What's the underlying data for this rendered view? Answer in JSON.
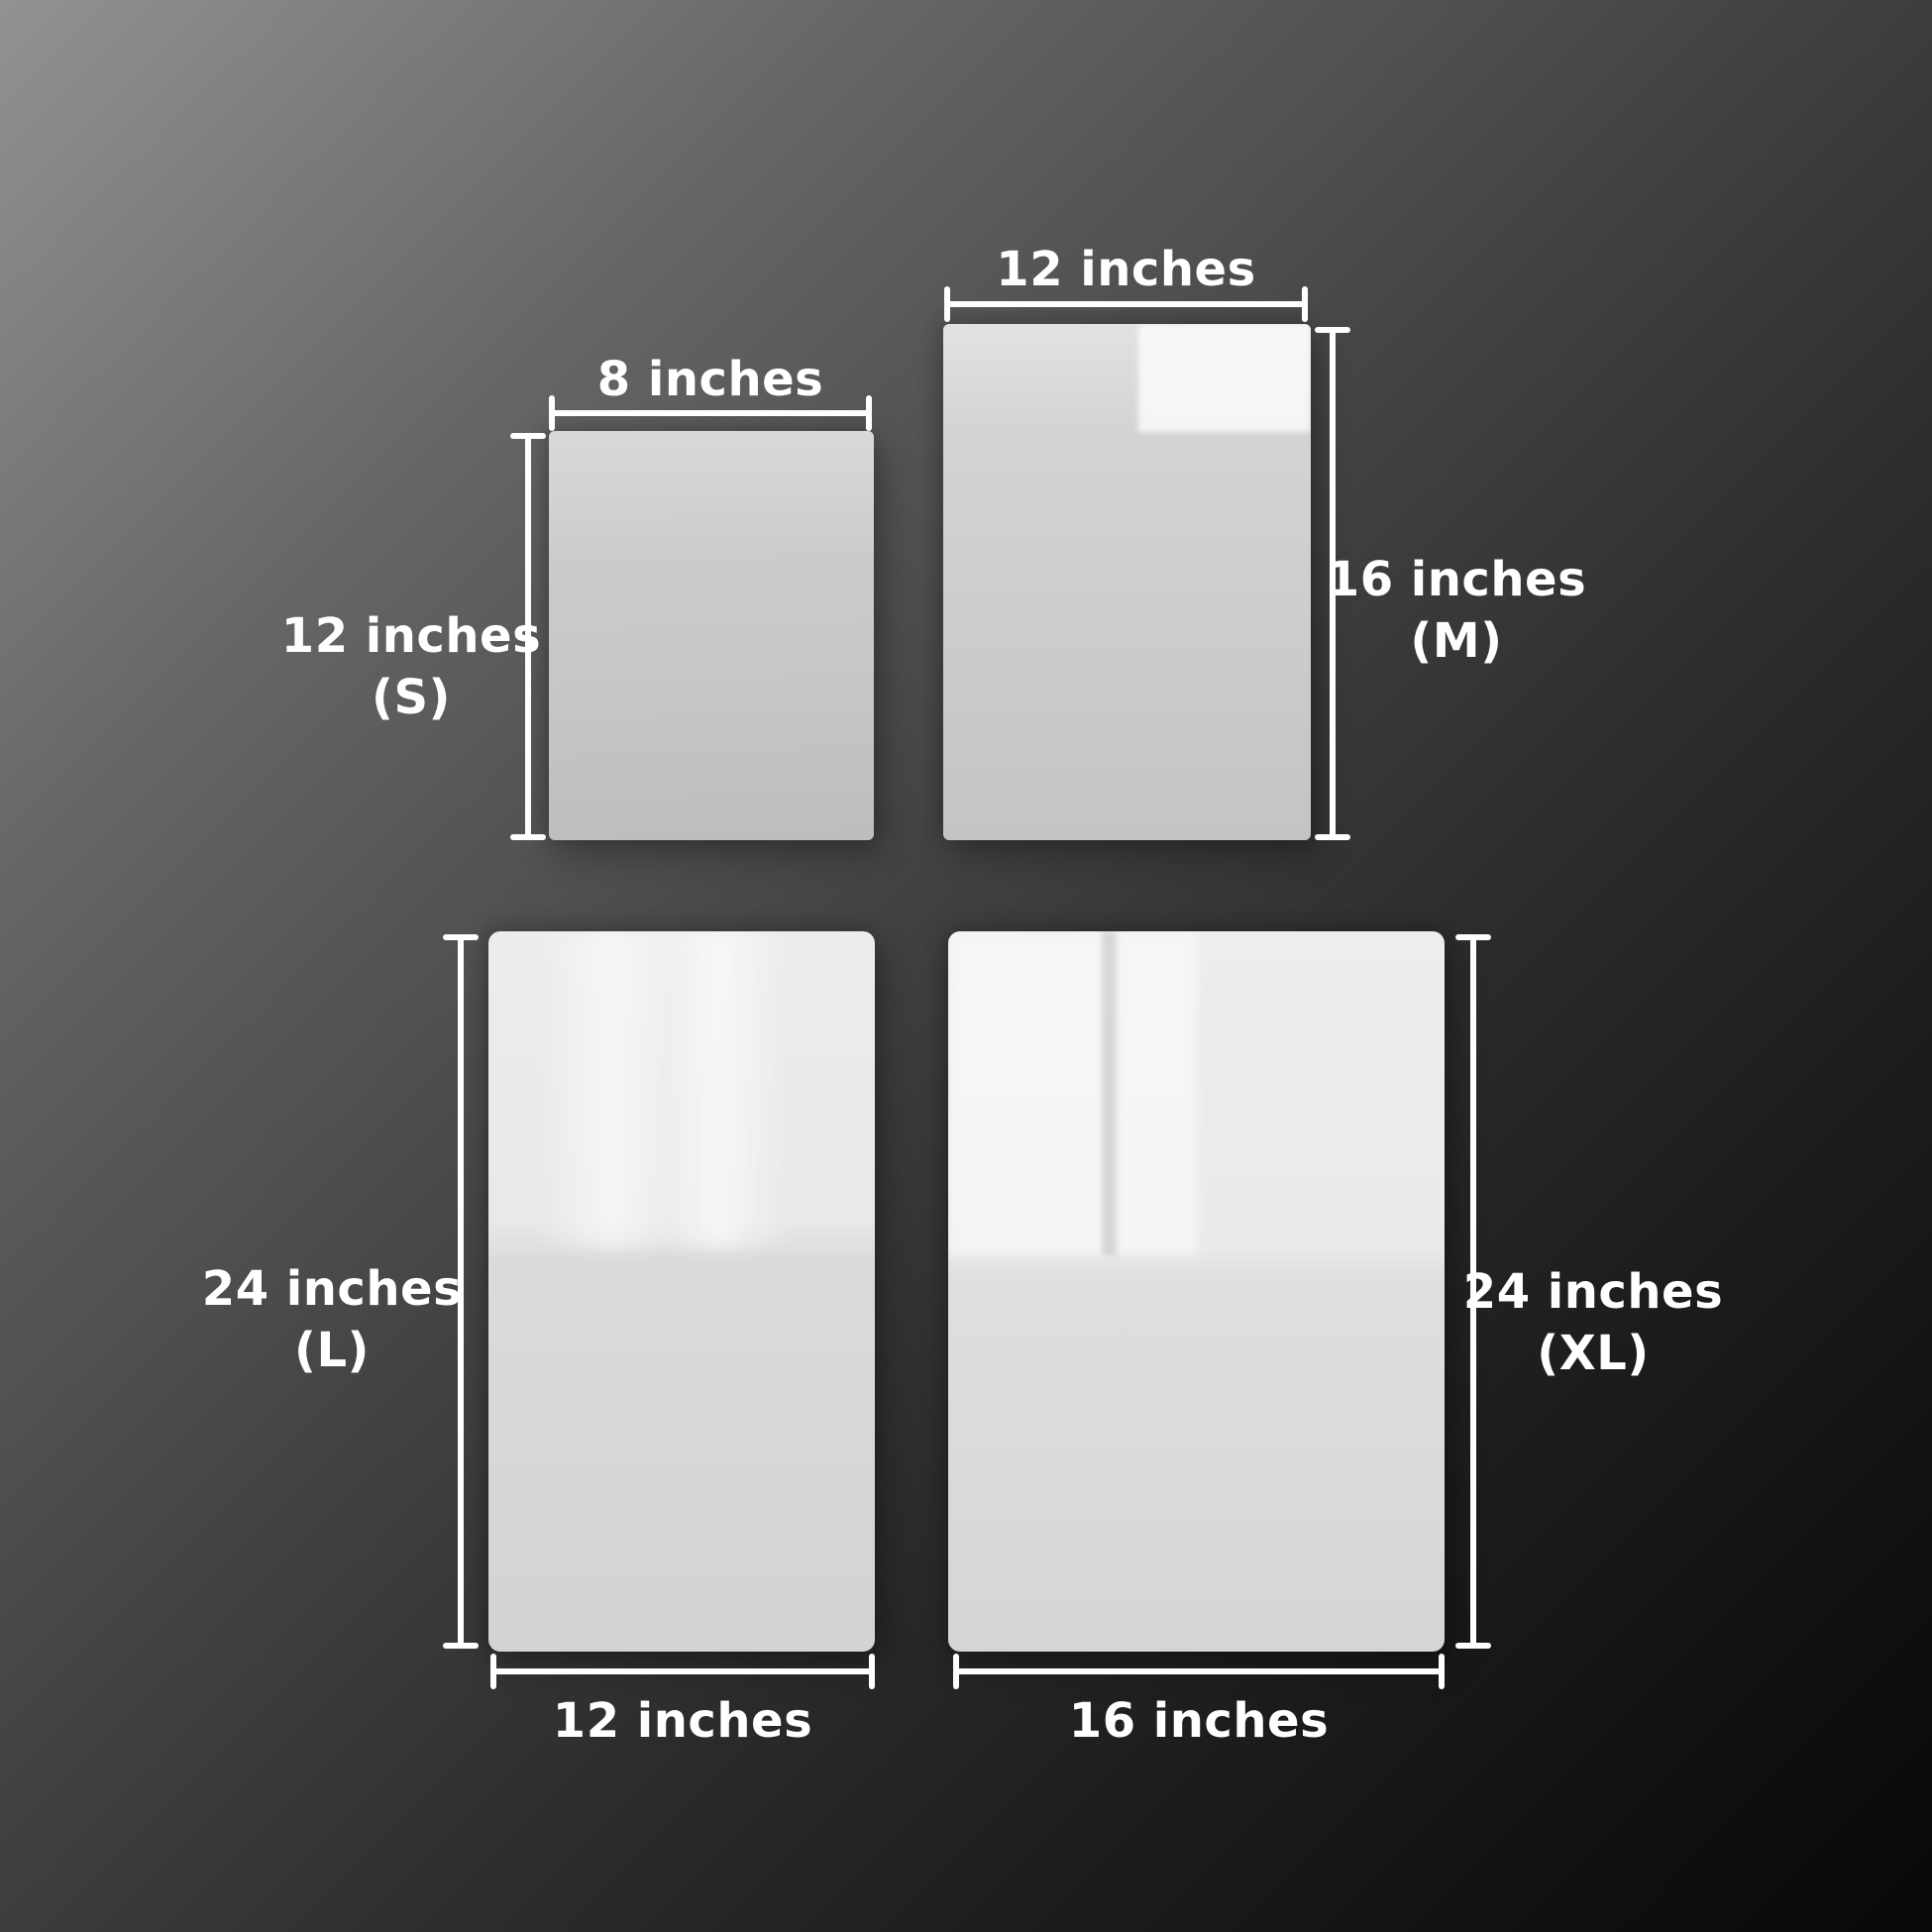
{
  "panels": [
    {
      "id": "S",
      "size_code": "(S)",
      "width_label": "8 inches",
      "height_label": "12 inches",
      "width_inches": 8,
      "height_inches": 12
    },
    {
      "id": "M",
      "size_code": "(M)",
      "width_label": "12 inches",
      "height_label": "16 inches",
      "width_inches": 12,
      "height_inches": 16
    },
    {
      "id": "L",
      "size_code": "(L)",
      "width_label": "12 inches",
      "height_label": "24 inches",
      "width_inches": 12,
      "height_inches": 24
    },
    {
      "id": "XL",
      "size_code": "(XL)",
      "width_label": "16 inches",
      "height_label": "24 inches",
      "width_inches": 16,
      "height_inches": 24
    }
  ],
  "colors": {
    "label_text": "#ffffff",
    "dimension_lines": "#ffffff",
    "panel_surface_light": "#f0f0f0",
    "panel_surface_mid": "#c9c9c9",
    "background_top_left": "#929292",
    "background_bottom_right": "#090909"
  }
}
